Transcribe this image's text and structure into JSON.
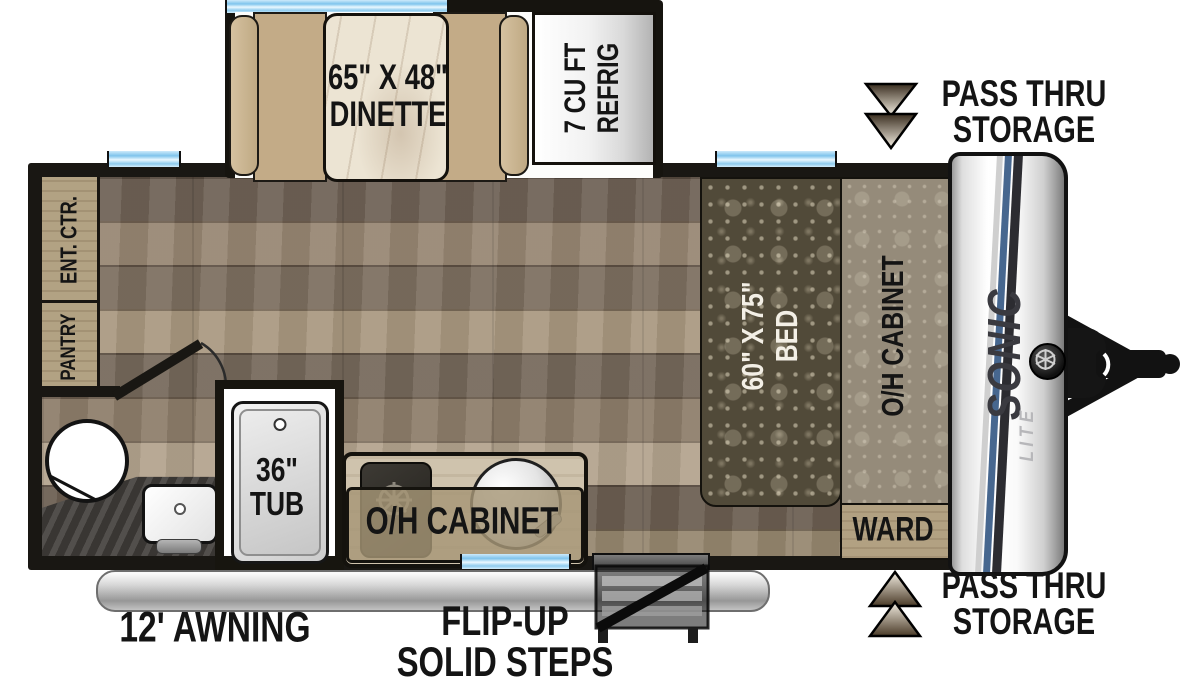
{
  "plan": {
    "slideout": {
      "dinette_size": "65\" X 48\"",
      "dinette_label": "DINETTE",
      "refrig_line1": "7 CU FT",
      "refrig_line2": "REFRIG"
    },
    "storage_top": {
      "line1": "PASS THRU",
      "line2": "STORAGE"
    },
    "storage_bottom": {
      "line1": "PASS THRU",
      "line2": "STORAGE"
    },
    "left_wall": {
      "ent_ctr": "ENT. CTR.",
      "pantry": "PANTRY"
    },
    "bathroom": {
      "tub_size": "36\"",
      "tub_label": "TUB"
    },
    "kitchen": {
      "oh_cabinet": "O/H CABINET"
    },
    "bedroom": {
      "bed_size": "60\" X 75\"",
      "bed_label": "BED",
      "oh_cabinet": "O/H CABINET",
      "ward": "WARD"
    },
    "exterior": {
      "awning": "12' AWNING",
      "steps_line1": "FLIP-UP",
      "steps_line2": "SOLID STEPS",
      "brand": "SONIC",
      "brand_sub": "LITE"
    }
  },
  "colors": {
    "wall": "#191713",
    "window_blue": "#8ecbee",
    "bench_tan": "#c3ab87",
    "table_marble": "#ece4d3",
    "bed_fabric": "#514a39",
    "cabinet_fabric": "#958b7a",
    "wood_floor": "#8b7c6b",
    "cabinet_wood": "#b2a283",
    "stripe_blue": "#47678f",
    "arrow_brown": "#3a2e20",
    "counter_dark": "#45423e"
  }
}
